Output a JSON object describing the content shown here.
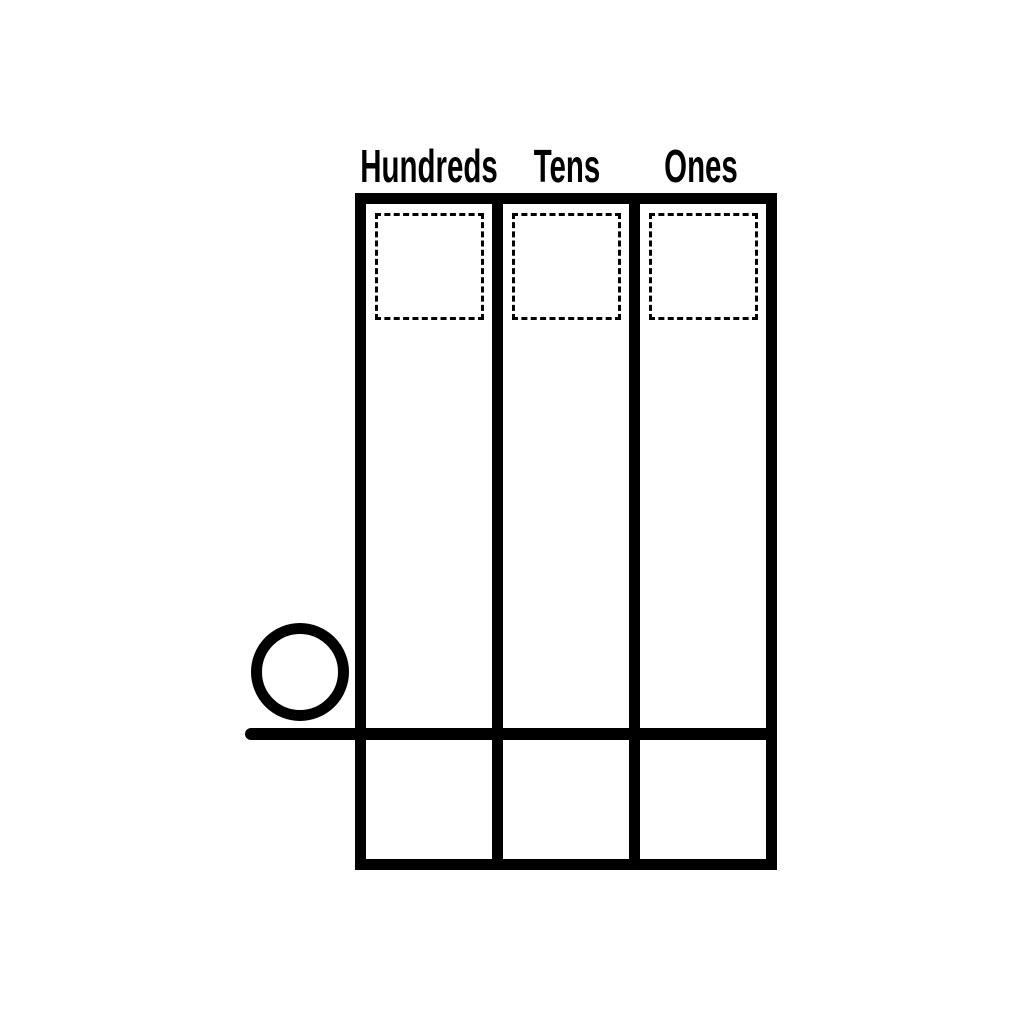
{
  "worksheet": {
    "type": "place-value-chart",
    "headers": [
      {
        "label": "Hundreds"
      },
      {
        "label": "Tens"
      },
      {
        "label": "Ones"
      }
    ],
    "icons": {
      "regroup_circle": "circle-outline",
      "dropzone": "dashed-square"
    },
    "colors": {
      "ink": "#000000",
      "background": "#ffffff"
    }
  }
}
